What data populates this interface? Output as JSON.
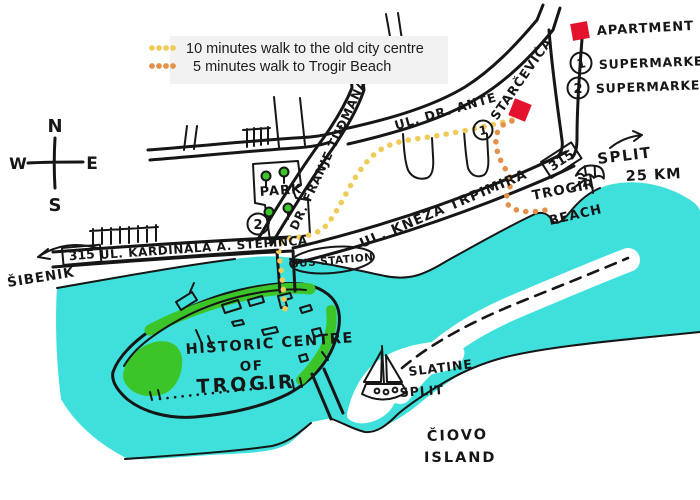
{
  "legend": {
    "walk_city": "10 minutes walk to the old city centre",
    "walk_beach": "5 minutes walk to Trogir Beach"
  },
  "key": {
    "apartment": "APARTMENT",
    "supermarket_1": "SUPERMARKET",
    "supermarket_2": "SUPERMARKET",
    "marker_1": "1",
    "marker_2": "2"
  },
  "compass": {
    "north": "N",
    "east": "E",
    "south": "S",
    "west": "W"
  },
  "streets": {
    "ante_1": "UL. DR. ANTE",
    "ante_2": "STARČEVIĆA",
    "tudjmana": "DR. FRANJE TUĐMANA",
    "trpimira": "UL. KNEZA TRPIMIRA",
    "stepinca": "UL. KARDINALA A. STEPINCA"
  },
  "signs": {
    "route_left": "315",
    "route_right": "315"
  },
  "labels": {
    "park": "PARK",
    "bus_station": "BUS STATION",
    "sibenik": "ŠIBENIK",
    "split": "SPLIT",
    "split_distance": "25 KM",
    "trogir": "TROGIR",
    "beach": "BEACH",
    "historic_line1": "HISTORIC CENTRE",
    "historic_line2": "OF",
    "historic_line3": "TROGIR",
    "slatine": "SLATINE",
    "slatine_split": "SPLIT",
    "ciovo_line1": "ČIOVO",
    "ciovo_line2": "ISLAND"
  },
  "colors": {
    "water": "#3FE0DB",
    "park_green": "#3CC528",
    "apartment_red": "#E3132E",
    "route_city": "#EFCB5A",
    "route_beach": "#E2914B",
    "ink": "#161616",
    "legend_bg": "#F2F2F2"
  }
}
